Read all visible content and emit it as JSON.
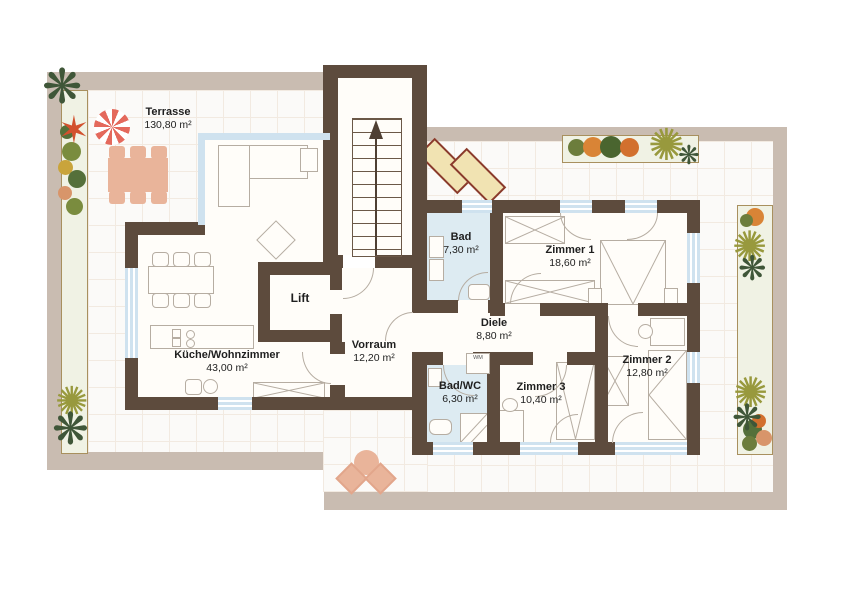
{
  "plan_title": "Wohnung Grundriss",
  "rooms": [
    {
      "name": "Terrasse",
      "area": "130,80 m²"
    },
    {
      "name": "Küche/Wohnzimmer",
      "area": "43,00 m²"
    },
    {
      "name": "Vorraum",
      "area": "12,20 m²"
    },
    {
      "name": "Diele",
      "area": "8,80 m²"
    },
    {
      "name": "Bad",
      "area": "7,30 m²"
    },
    {
      "name": "Zimmer 1",
      "area": "18,60 m²"
    },
    {
      "name": "Zimmer 2",
      "area": "12,80 m²"
    },
    {
      "name": "Zimmer 3",
      "area": "10,40 m²"
    },
    {
      "name": "Bad/WC",
      "area": "6,30 m²"
    },
    {
      "name": "Lift",
      "area": ""
    }
  ],
  "labels": {
    "washing_machine": "WM"
  },
  "colors": {
    "wall": "#5d4b3d",
    "terrace_border": "#c9bcb1",
    "room_floor": "#fffdf9",
    "wet_room_floor": "#ddebf2",
    "window": "#cfe2ef",
    "terrace_furniture": "#e9b49a",
    "parasol": "#e4695c",
    "planter_fill": "#f0f2e4"
  }
}
